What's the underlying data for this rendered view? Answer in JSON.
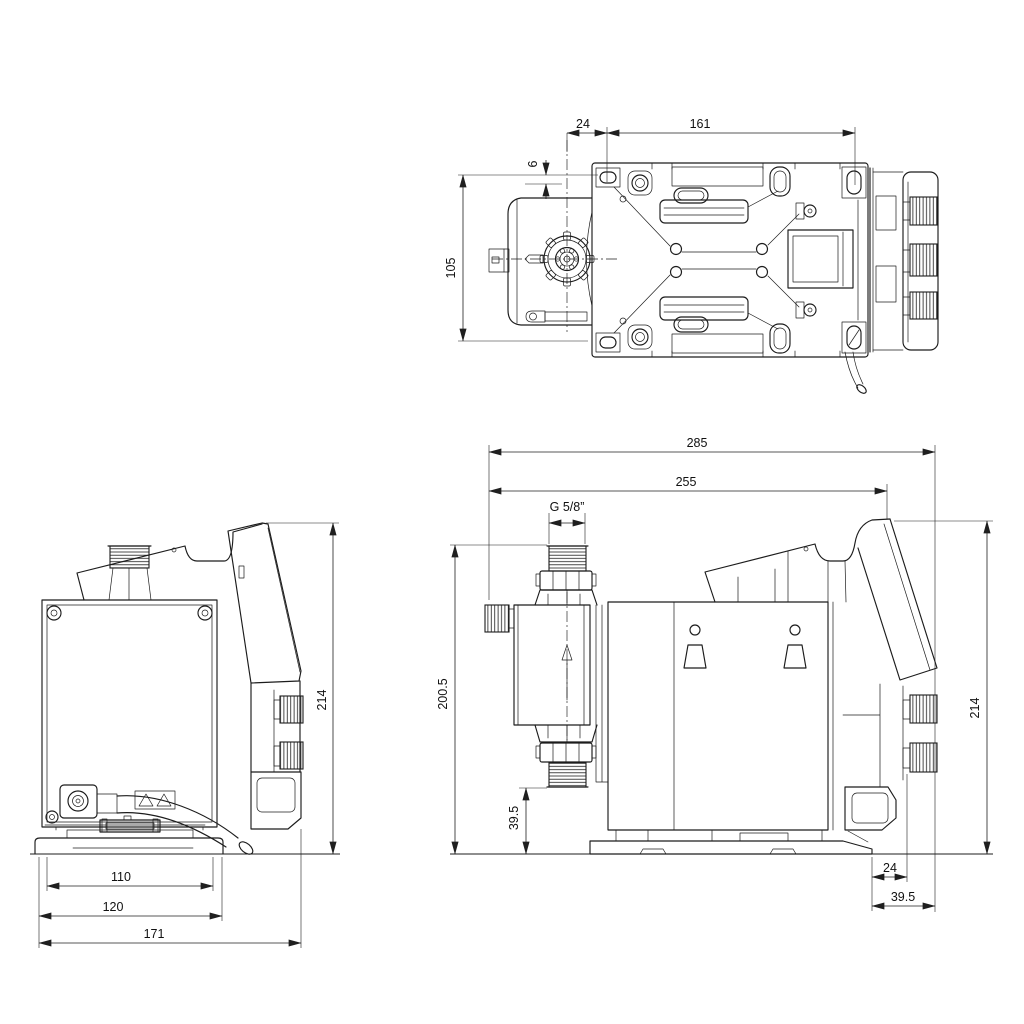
{
  "drawing": {
    "colors": {
      "background": "#ffffff",
      "line": "#1c1c1c",
      "text": "#111111"
    },
    "top_view": {
      "dim_24": "24",
      "dim_161": "161",
      "dim_6": "6",
      "dim_105": "105"
    },
    "side_view": {
      "dim_214": "214",
      "dim_110": "110",
      "dim_120": "120",
      "dim_171": "171"
    },
    "front_view": {
      "dim_285": "285",
      "dim_255": "255",
      "dim_thread": "G 5/8”",
      "dim_200_5": "200.5",
      "dim_39_5_side": "39.5",
      "dim_214": "214",
      "dim_24": "24",
      "dim_39_5_bottom": "39.5"
    }
  }
}
